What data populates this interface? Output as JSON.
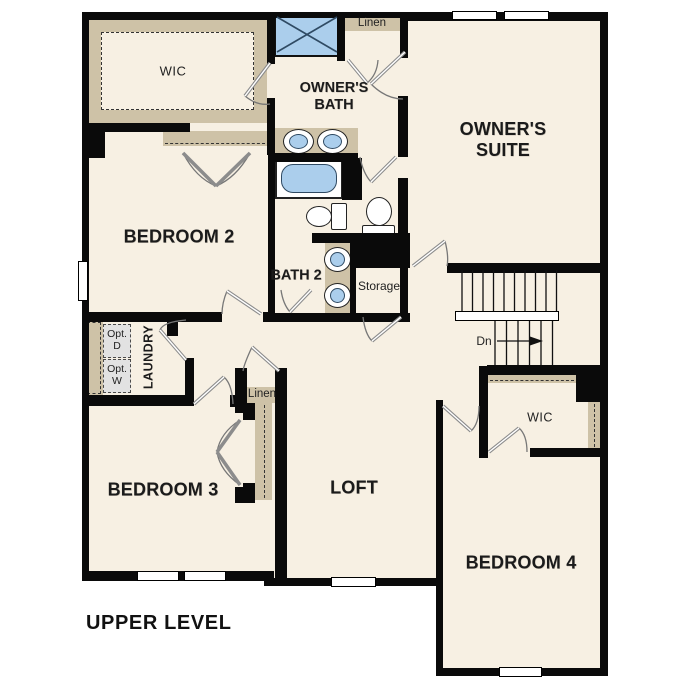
{
  "plan_title": "UPPER LEVEL",
  "rooms": {
    "wic_upper_left": "WIC",
    "owners_bath": "OWNER'S\nBATH",
    "linen_upper": "Linen",
    "owners_suite": "OWNER'S\nSUITE",
    "bedroom_2": "BEDROOM 2",
    "bath_2": "BATH 2",
    "storage": "Storage",
    "laundry": "LAUNDRY",
    "opt_dryer": "Opt.\nD",
    "opt_washer": "Opt.\nW",
    "linen_middle": "Linen",
    "bedroom_3": "BEDROOM 3",
    "loft": "LOFT",
    "wic_bedroom4": "WIC",
    "bedroom_4": "BEDROOM 4"
  },
  "stairs": {
    "direction_label": "Dn"
  },
  "colors": {
    "floor": "#f7f0e3",
    "wall": "#0a0a0a",
    "casework": "#cec2a7",
    "fixture_fill": "#abceec",
    "fixture_stroke": "#2f4a63",
    "optional_fill": "#e2e2e2",
    "door_swing": "#8c8c8c",
    "label": "#1b1b1b"
  }
}
